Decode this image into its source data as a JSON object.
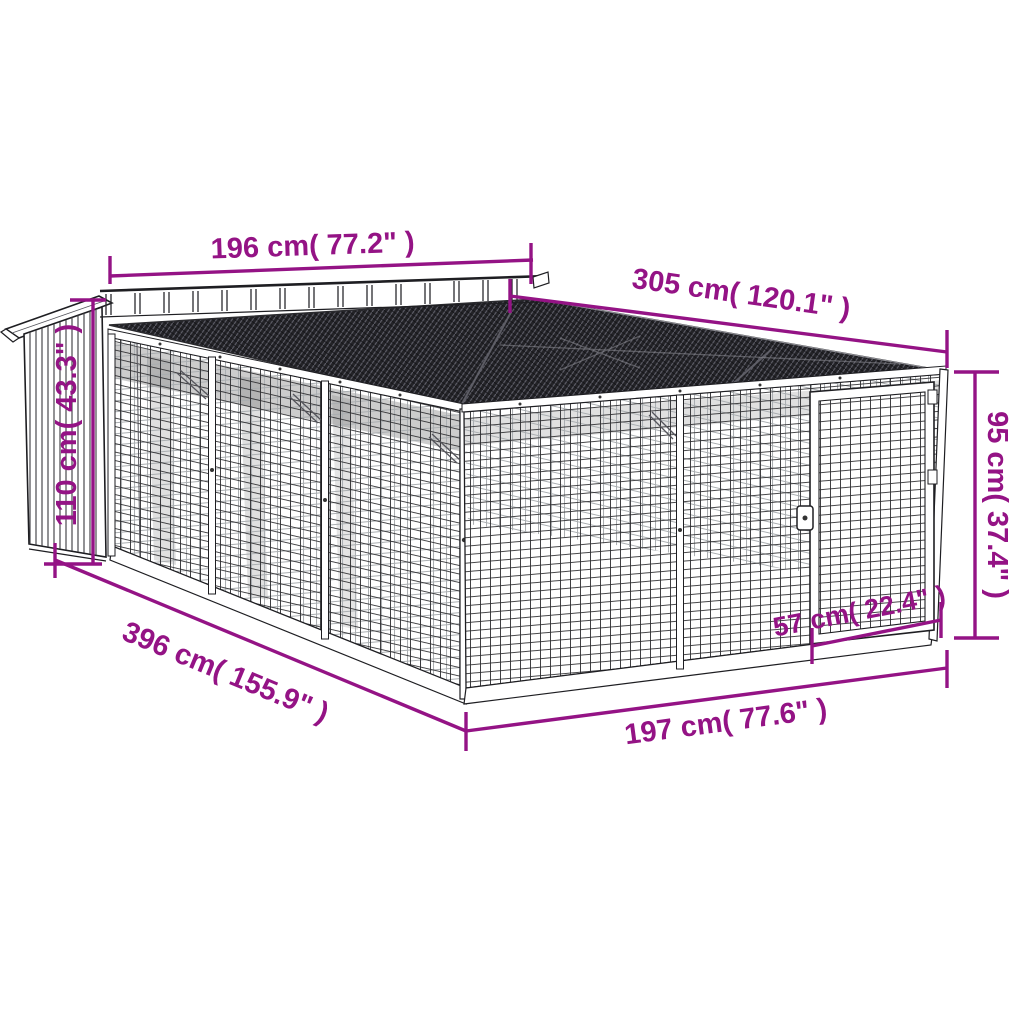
{
  "figure": {
    "kind": "product-dimension-diagram"
  },
  "colors": {
    "dimension": "#941385",
    "outline": "#1e1e22",
    "roof": "#232327",
    "mesh": "#2d2d30",
    "background": "#ffffff"
  },
  "dimensions": {
    "roof_width": {
      "label": "196 cm( 77.2\" )"
    },
    "run_length": {
      "label": "305 cm( 120.1\" )"
    },
    "house_height": {
      "label": "110 cm( 43.3\" )"
    },
    "run_height": {
      "label": "95 cm( 37.4\" )"
    },
    "total_length": {
      "label": "396 cm( 155.9\" )"
    },
    "front_width": {
      "label": "197 cm( 77.6\" )"
    },
    "door_width": {
      "label": "57 cm( 22.4\" )"
    }
  }
}
